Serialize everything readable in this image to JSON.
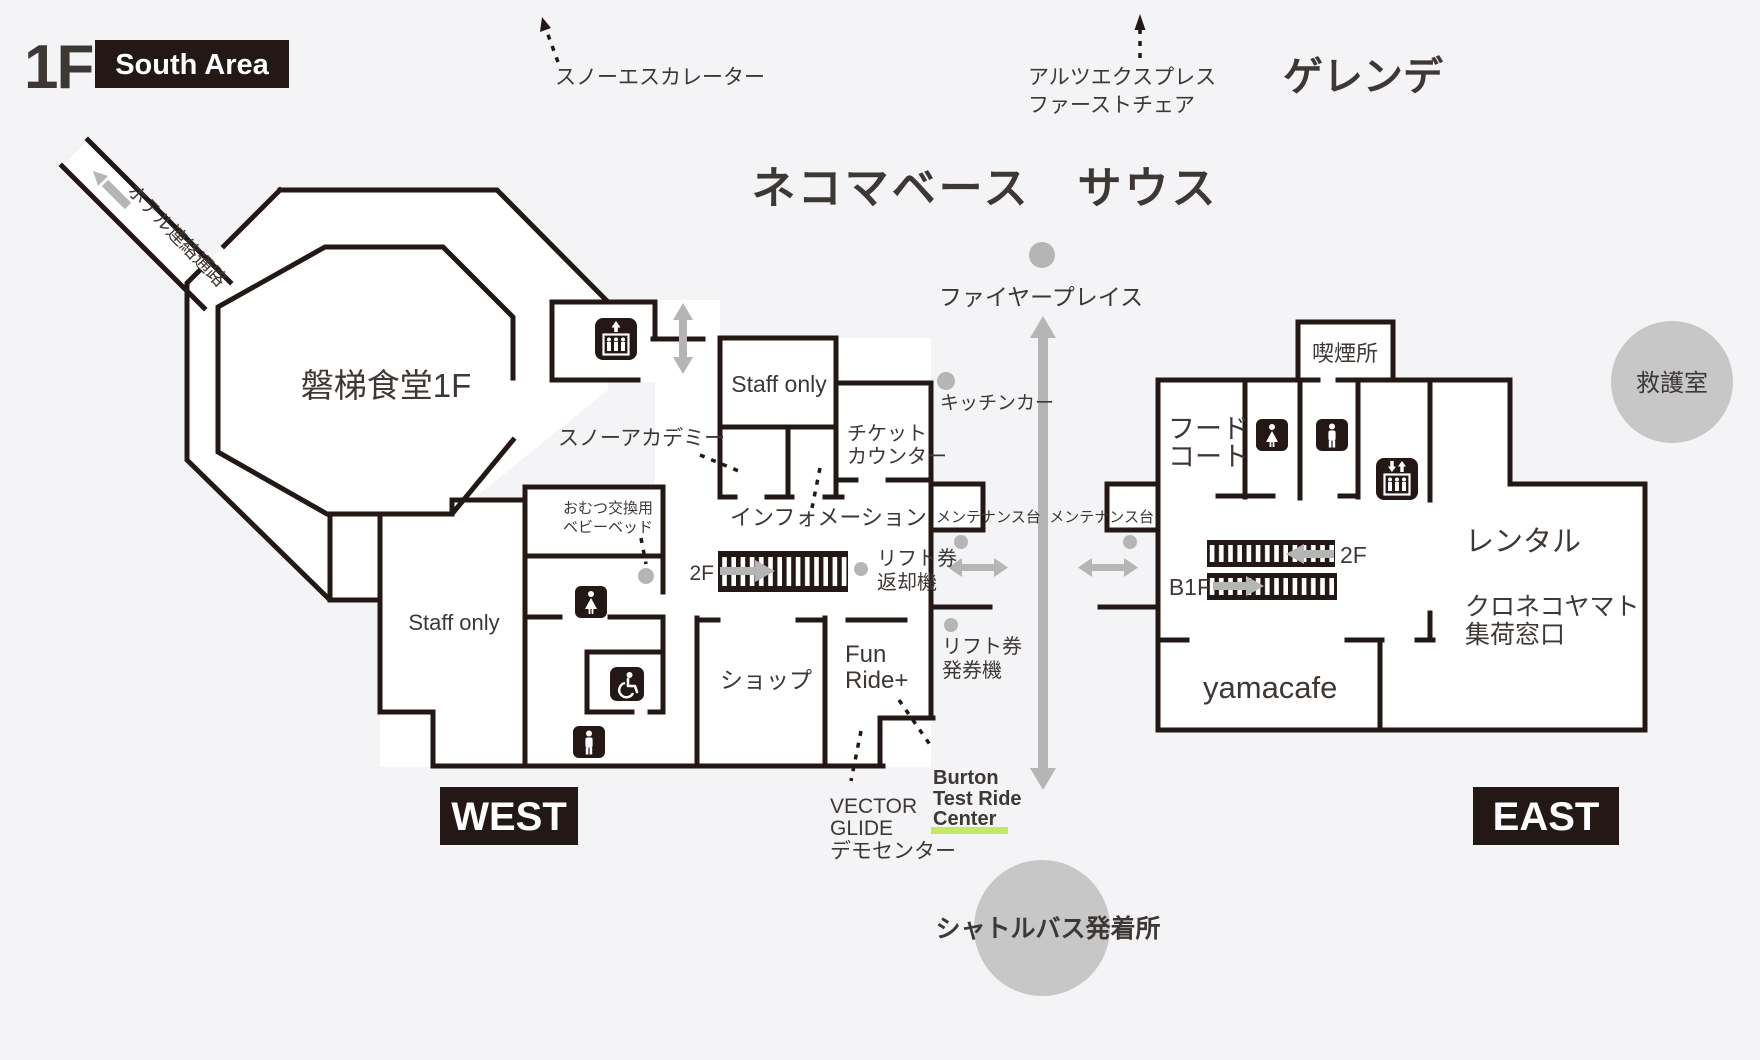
{
  "header": {
    "floor": "1F",
    "area_badge": "South Area",
    "title": "ネコマベース　サウス",
    "slope": "ゲレンデ"
  },
  "annotations": {
    "snow_escalator": "スノーエスカレーター",
    "alts_express_line1": "アルツエクスプレス",
    "alts_express_line2": "ファーストチェア",
    "hotel_corridor": "ホテル連絡通路",
    "fireplace": "ファイヤープレイス",
    "kitchen_car": "キッチンカー",
    "maintenance_west": "メンテナンス台",
    "maintenance_east": "メンテナンス台",
    "lift_return_line1": "リフト券",
    "lift_return_line2": "返却機",
    "lift_issue_line1": "リフト券",
    "lift_issue_line2": "発券機",
    "shuttle_bus": "シャトルバス発着所",
    "first_aid": "救護室",
    "vector_glide_line1": "VECTOR",
    "vector_glide_line2": "GLIDE",
    "vector_glide_line3": "デモセンター",
    "burton_line1": "Burton",
    "burton_line2": "Test Ride",
    "burton_line3": "Center"
  },
  "west": {
    "badge": "WEST",
    "rooms": {
      "restaurant": "磐梯食堂1F",
      "staff_upper": "Staff only",
      "staff_lower": "Staff only",
      "ticket_line1": "チケット",
      "ticket_line2": "カウンター",
      "snow_academy": "スノーアカデミー",
      "information": "インフォメーション",
      "diaper_line1": "おむつ交換用",
      "diaper_line2": "ベビーベッド",
      "shop": "ショップ",
      "fun_ride_line1": "Fun",
      "fun_ride_line2": "Ride+",
      "stairs_2f": "2F"
    }
  },
  "east": {
    "badge": "EAST",
    "rooms": {
      "smoking": "喫煙所",
      "food_court_line1": "フード",
      "food_court_line2": "コート",
      "rental": "レンタル",
      "kuroneko_line1": "クロネコヤマト",
      "kuroneko_line2": "集荷窓口",
      "yamacafe": "yamacafe",
      "stairs_2f": "2F",
      "stairs_b1f": "B1F"
    }
  },
  "colors": {
    "wall": "#231815",
    "background": "#f4f4f6",
    "arrow_gray": "#b5b5b6",
    "circle_gray": "#c7c7c8",
    "center_highlight": "#c3e95f"
  }
}
